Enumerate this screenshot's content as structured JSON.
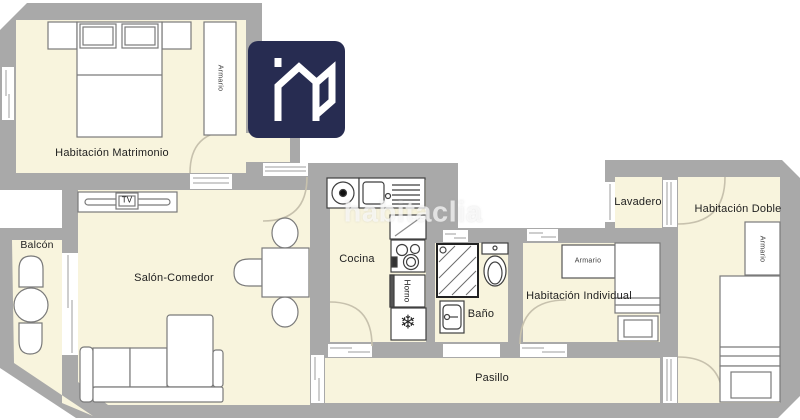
{
  "brand": {
    "watermark": "habitaclia",
    "logo_icon": "habitaclia-house-logo"
  },
  "palette": {
    "wall": "#a9a9a9",
    "floor": "#f8f4dd",
    "logo_bg": "#272c51",
    "furniture_stroke": "#7a7a7a",
    "appliance_stroke": "#3f3f3f",
    "door_arc": "#c7c1ad"
  },
  "rooms": {
    "matrimonio": {
      "label": "Habitación Matrimonio"
    },
    "balcon": {
      "label": "Balcón"
    },
    "salon": {
      "label": "Salón-Comedor"
    },
    "cocina": {
      "label": "Cocina"
    },
    "bano": {
      "label": "Baño"
    },
    "pasillo": {
      "label": "Pasillo"
    },
    "individual": {
      "label": "Habitación Individual"
    },
    "lavadero": {
      "label": "Lavadero"
    },
    "doble": {
      "label": "Habitación Doble"
    }
  },
  "furniture_labels": {
    "tv": "TV",
    "horno": "Horno",
    "armario": "Armario"
  },
  "icons": {
    "freezer_snowflake": "❄"
  }
}
